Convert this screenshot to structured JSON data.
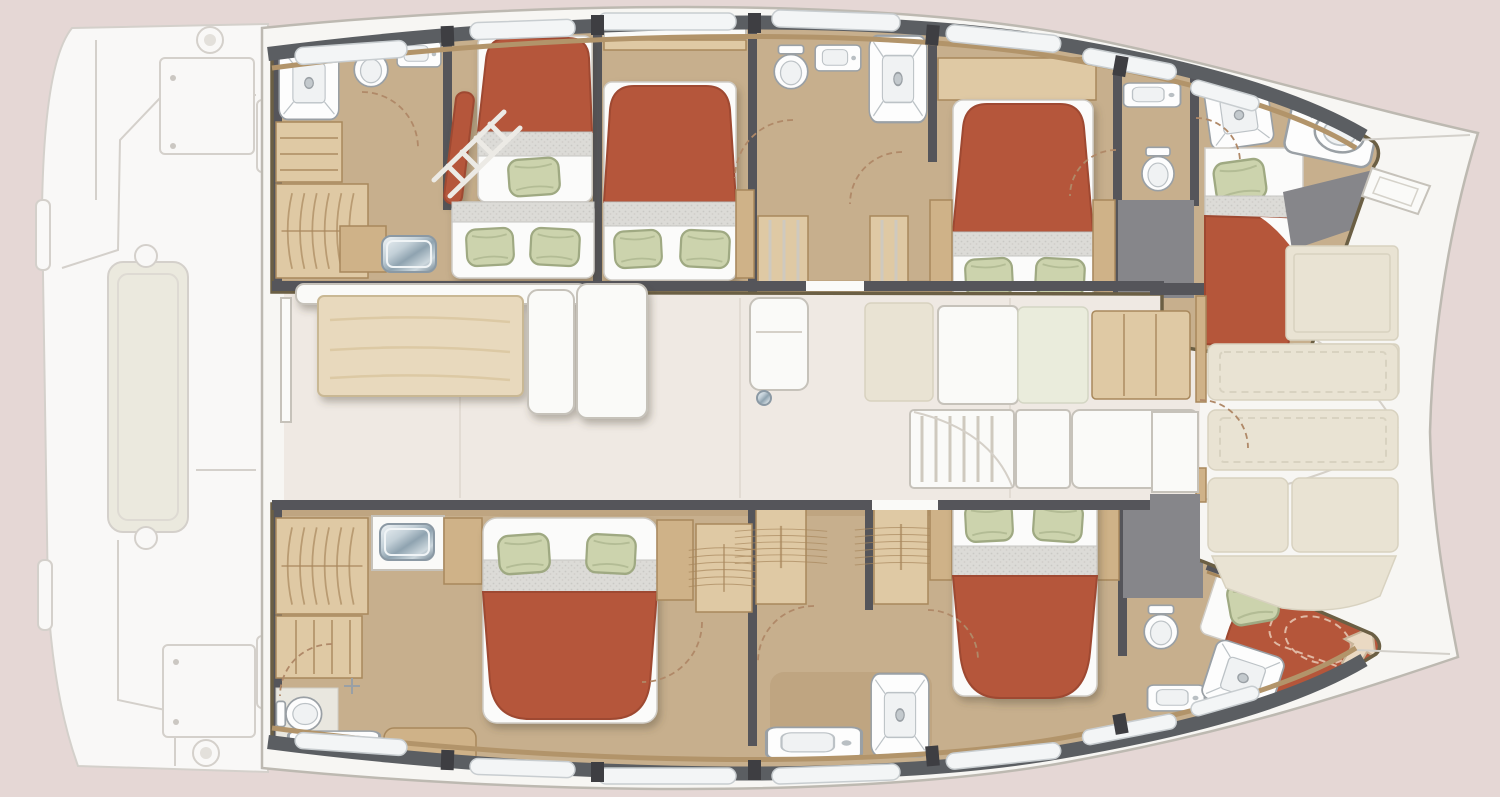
{
  "image": {
    "kind": "yacht interior floor plan",
    "vessel": "sailing catamaran, top-down deck plan, bow pointing right",
    "visible_text": "none"
  },
  "palette": {
    "bg": "#e5d7d5",
    "deckFaint": "#fcfcfb",
    "deckLine": "#d3d0ca",
    "hullWhite": "#f7f6f3",
    "hullLine": "#bdb9b1",
    "floorTan": "#c7af8d",
    "floorTanDark": "#b89d78",
    "woodLight": "#dfc9a4",
    "wood": "#cfb288",
    "woodDark": "#a8885c",
    "trimOlive": "#6b5f44",
    "wallGray": "#55555a",
    "wallGrayDark": "#3e3e42",
    "windowWhite": "#f3f5f6",
    "windowBand": "#5b5e62",
    "sillWood": "#b2946a",
    "bedRed": "#b5563a",
    "bedRedDark": "#9e4830",
    "sheetGray": "#dcdbd7",
    "sheetWhite": "#fbfbfa",
    "pillowGreen": "#ccd3ad",
    "pillowGreenDark": "#9fa982",
    "salonFloor": "#efe9e3",
    "cream": "#e9e3d3",
    "creamDark": "#d8d2c0",
    "whiteFurn": "#fafaf8",
    "furnLine": "#c6c2ba",
    "grayFloor": "#86868a",
    "tileFloor": "#e9e7df",
    "fixtureLine": "#9aa0a5",
    "arrowCream": "#ead9c3",
    "dashColor": "#b08968"
  },
  "layout": {
    "aft_deck": {
      "position": "left, drawn faded",
      "features": [
        "swim platform steps",
        "cockpit storage locker",
        "long cockpit bench with end knobs",
        "aft locker hatch",
        "two winches",
        "deck seam lines"
      ]
    },
    "port_hull_top": {
      "rooms": [
        {
          "name": "aft bathroom",
          "furniture": [
            "shower tray",
            "toilet",
            "washbasin",
            "shelf unit",
            "hanging wardrobe",
            "chrome sink vanity",
            "door swing"
          ]
        },
        {
          "name": "aft bunk cabin",
          "furniture": [
            "upper single berth with pillow",
            "lower double berth with two pillows",
            "boarding ladder",
            "red bolster"
          ]
        },
        {
          "name": "mid double cabin",
          "furniture": [
            "double bed with two pillows",
            "overhead locker",
            "bedside shelf"
          ]
        },
        {
          "name": "mid bathroom",
          "furniture": [
            "toilet",
            "washbasin",
            "shower tray",
            "step lockers",
            "door swings"
          ]
        },
        {
          "name": "forward double cabin",
          "furniture": [
            "double bed with two pillows",
            "overhead shelf",
            "bedside tables",
            "private WC with toilet and washbasin",
            "grey wet floor"
          ]
        },
        {
          "name": "forepeak crew cabin",
          "furniture": [
            "single berth with pillow",
            "shower tray",
            "bow toilet in tray",
            "grey locker area"
          ]
        }
      ]
    },
    "starboard_hull_bottom": {
      "rooms": [
        {
          "name": "owner cabin",
          "furniture": [
            "double bed with two pillows",
            "hanging wardrobe",
            "shelf column",
            "vanity with chrome sink",
            "wood desk",
            "toilet",
            "tiled shower corner with mixer",
            "washbasin counter",
            "wood bench",
            "door swings"
          ]
        },
        {
          "name": "forward double cabin",
          "furniture": [
            "double bed with two pillows",
            "two hanging wardrobes",
            "shower tray",
            "washbasin counter",
            "toilet",
            "washbasin",
            "grey wet floor"
          ]
        },
        {
          "name": "forepeak crew cabin",
          "furniture": [
            "single berth with pillow",
            "red V-berth",
            "dashed optional berth outline",
            "direction arrow",
            "shower tray"
          ]
        }
      ]
    },
    "salon": {
      "furniture": [
        "wood dining table",
        "L-shaped white sofa",
        "chaise module",
        "galley aft unit with faucet",
        "beige counter",
        "white island",
        "pale green counter",
        "wood plank counter",
        "slatted companionway stairs",
        "white chart counter",
        "forward door with swing"
      ]
    },
    "forward_cockpit": {
      "furniture": [
        "sun pad upper",
        "sun pad lower",
        "bench seat forward-facing",
        "bench seat aft-facing",
        "two lower bench cushions",
        "angled lounge pad",
        "white fridge unit",
        "grey access strip"
      ]
    },
    "bow_area": {
      "features": [
        "port bow point",
        "starboard bow point",
        "anchor locker hatch",
        "deck seam lines"
      ]
    },
    "totals": {
      "sleeping_cabins": 6,
      "double_beds": 5,
      "single_berths": 3,
      "showers": 5,
      "toilets": 6,
      "washbasins": 7,
      "bedspread_color": "terracotta red",
      "pillow_color": "sage green"
    }
  }
}
